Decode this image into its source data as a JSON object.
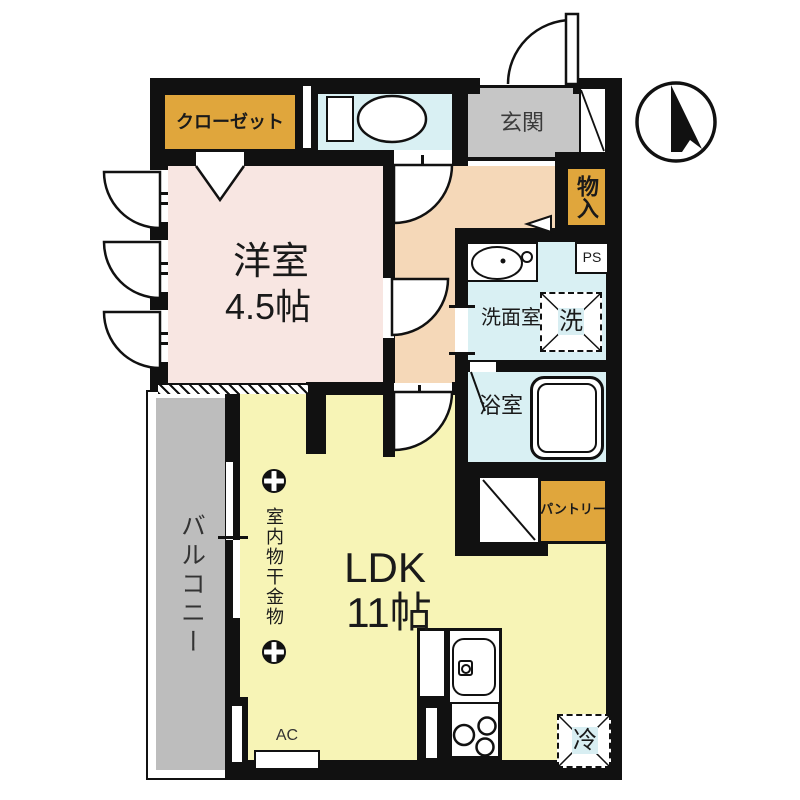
{
  "rooms": {
    "western_room": {
      "label": "洋室",
      "size": "4.5帖"
    },
    "ldk": {
      "label": "LDK",
      "size": "11帖"
    },
    "balcony": {
      "label": "バルコニー"
    },
    "entrance": {
      "label": "玄関"
    },
    "closet": {
      "label": "クローゼット"
    },
    "storage": {
      "label": "物入"
    },
    "washroom": {
      "label": "洗面室"
    },
    "bathroom": {
      "label": "浴室"
    },
    "pantry": {
      "label": "パントリー"
    },
    "pipe_space": {
      "label": "PS"
    }
  },
  "fixtures": {
    "washing_machine": {
      "label": "洗"
    },
    "refrigerator": {
      "label": "冷"
    },
    "air_conditioner": {
      "label": "AC"
    },
    "laundry_hanger": {
      "label": "室内物干金物"
    }
  },
  "colors": {
    "wall": "#111111",
    "ldk_yellow": "#F7F4B6",
    "western_pink": "#F8E6E2",
    "hall_peach": "#F5D8B8",
    "wet_area_cyan": "#D9F0F3",
    "entrance_gray": "#C6C6C6",
    "balcony_gray": "#BDBDBD",
    "storage_gold": "#E0A63C"
  }
}
